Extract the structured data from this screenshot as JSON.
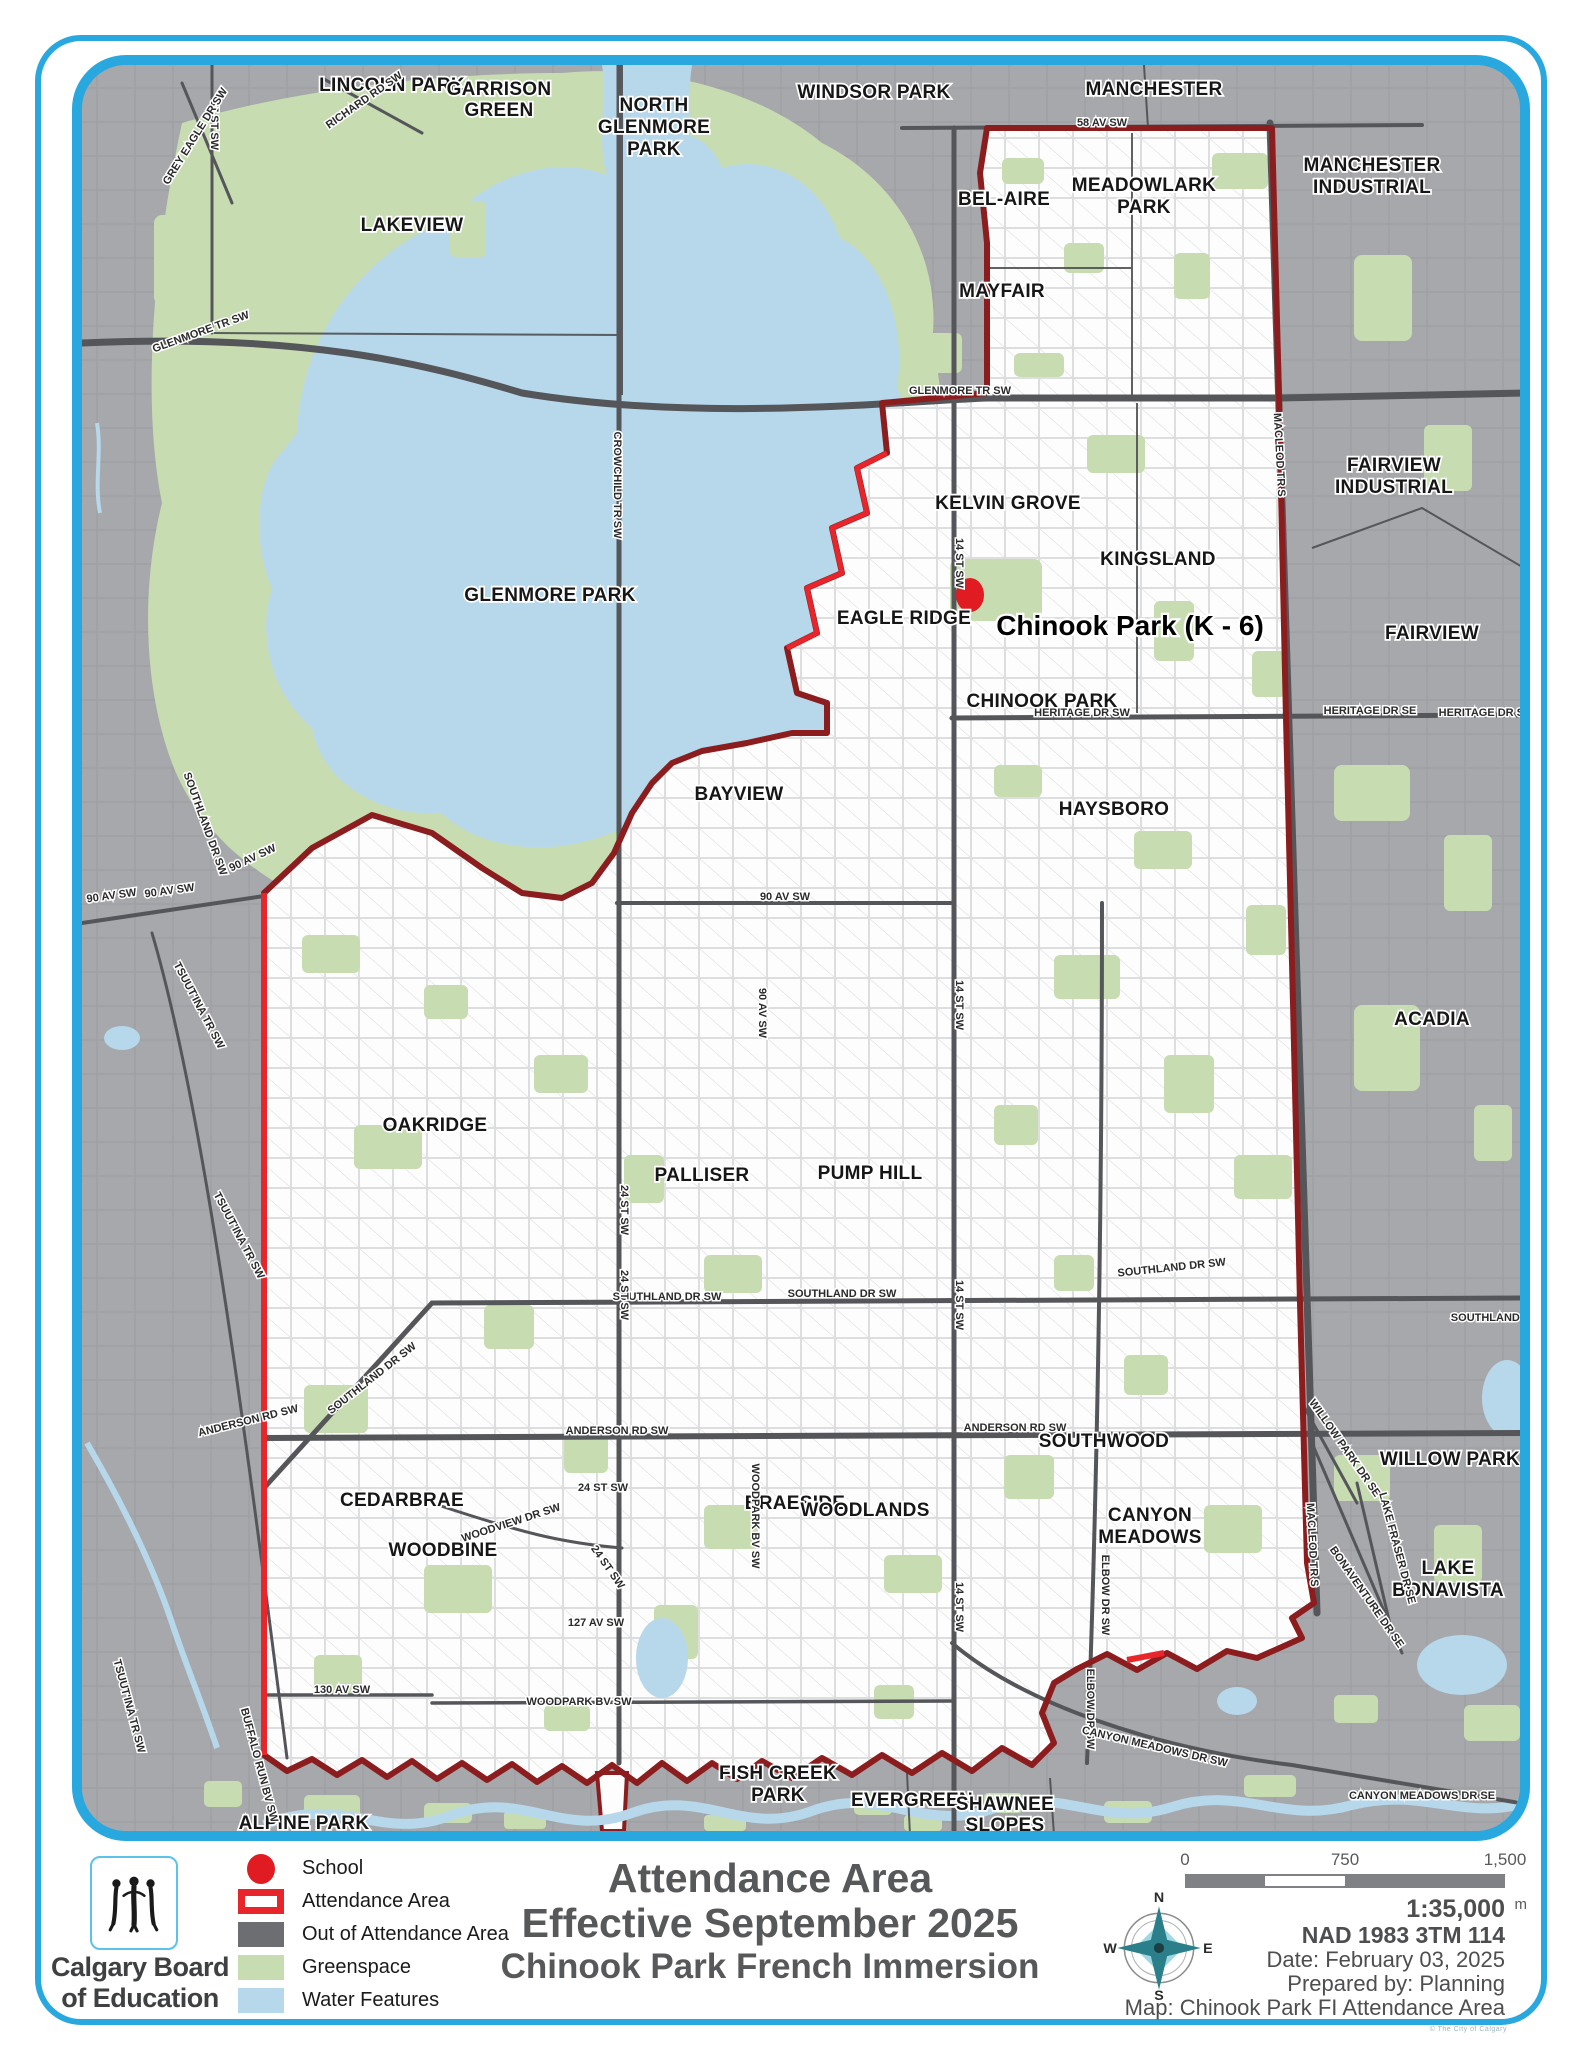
{
  "title": {
    "line1": "Attendance Area",
    "line2": "Effective September 2025",
    "line3": "Chinook Park French Immersion"
  },
  "logo": {
    "org_line1": "Calgary Board",
    "org_line2": "of Education"
  },
  "legend": {
    "items": [
      {
        "label": "School",
        "type": "school"
      },
      {
        "label": "Attendance Area",
        "type": "attendance"
      },
      {
        "label": "Out of Attendance Area",
        "type": "out"
      },
      {
        "label": "Greenspace",
        "type": "green"
      },
      {
        "label": "Water Features",
        "type": "water"
      }
    ]
  },
  "scale_bar": {
    "ticks": [
      "0",
      "750",
      "1,500"
    ],
    "unit": "m"
  },
  "compass": {
    "n": "N",
    "e": "E",
    "s": "S",
    "w": "W"
  },
  "map_info": {
    "scale_ratio": "1:35,000",
    "datum": "NAD 1983 3TM 114",
    "date_label": "Date: February 03, 2025",
    "prepared_label": "Prepared by: Planning",
    "map_label": "Map: Chinook Park FI Attendance Area"
  },
  "fine_print": "© The City of Calgary",
  "school": {
    "name": "Chinook Park (K - 6)",
    "x": 968,
    "y": 592
  },
  "colors": {
    "frame_blue": "#29a8e0",
    "out_of_area": "#a6a8ab",
    "attendance_white": "#ffffff",
    "greenspace": "#c8dcb2",
    "water": "#b7d7eb",
    "boundary_dark_red": "#8c1d1f",
    "boundary_bright_red": "#e8252a",
    "road": "#55565a",
    "title_gray": "#57585a"
  },
  "map": {
    "labels": [
      {
        "t": "LINCOLN PARK",
        "x": 390,
        "y": 88,
        "c": "nb"
      },
      {
        "t": "GARRISON",
        "x": 497,
        "y": 92,
        "c": "nb"
      },
      {
        "t": "GREEN",
        "x": 497,
        "y": 113,
        "c": "nb"
      },
      {
        "t": "NORTH",
        "x": 652,
        "y": 108,
        "c": "nb"
      },
      {
        "t": "GLENMORE",
        "x": 652,
        "y": 130,
        "c": "nb"
      },
      {
        "t": "PARK",
        "x": 652,
        "y": 152,
        "c": "nb"
      },
      {
        "t": "LAKEVIEW",
        "x": 410,
        "y": 228,
        "c": "nb"
      },
      {
        "t": "WINDSOR PARK",
        "x": 872,
        "y": 95,
        "c": "nb"
      },
      {
        "t": "MANCHESTER",
        "x": 1152,
        "y": 92,
        "c": "nb"
      },
      {
        "t": "MANCHESTER",
        "x": 1370,
        "y": 168,
        "c": "nb"
      },
      {
        "t": "INDUSTRIAL",
        "x": 1370,
        "y": 190,
        "c": "nb"
      },
      {
        "t": "BEL-AIRE",
        "x": 1002,
        "y": 202,
        "c": "nb"
      },
      {
        "t": "MEADOWLARK",
        "x": 1142,
        "y": 188,
        "c": "nb"
      },
      {
        "t": "PARK",
        "x": 1142,
        "y": 210,
        "c": "nb"
      },
      {
        "t": "MAYFAIR",
        "x": 1000,
        "y": 294,
        "c": "nb"
      },
      {
        "t": "FAIRVIEW",
        "x": 1392,
        "y": 468,
        "c": "nb"
      },
      {
        "t": "INDUSTRIAL",
        "x": 1392,
        "y": 490,
        "c": "nb"
      },
      {
        "t": "KELVIN GROVE",
        "x": 1006,
        "y": 506,
        "c": "nb"
      },
      {
        "t": "KINGSLAND",
        "x": 1156,
        "y": 562,
        "c": "nb"
      },
      {
        "t": "FAIRVIEW",
        "x": 1430,
        "y": 636,
        "c": "nb"
      },
      {
        "t": "GLENMORE PARK",
        "x": 548,
        "y": 598,
        "c": "nb"
      },
      {
        "t": "EAGLE RIDGE",
        "x": 902,
        "y": 621,
        "c": "nb"
      },
      {
        "t": "CHINOOK PARK",
        "x": 1040,
        "y": 704,
        "c": "nb"
      },
      {
        "t": "HAYSBORO",
        "x": 1112,
        "y": 812,
        "c": "nb"
      },
      {
        "t": "ACADIA",
        "x": 1430,
        "y": 1022,
        "c": "nb"
      },
      {
        "t": "BAYVIEW",
        "x": 737,
        "y": 797,
        "c": "nb"
      },
      {
        "t": "OAKRIDGE",
        "x": 433,
        "y": 1128,
        "c": "nb"
      },
      {
        "t": "PALLISER",
        "x": 700,
        "y": 1178,
        "c": "nb"
      },
      {
        "t": "PUMP HILL",
        "x": 868,
        "y": 1176,
        "c": "nb"
      },
      {
        "t": "SOUTHWOOD",
        "x": 1102,
        "y": 1444,
        "c": "nb"
      },
      {
        "t": "WILLOW PARK",
        "x": 1448,
        "y": 1462,
        "c": "nb"
      },
      {
        "t": "CEDARBRAE",
        "x": 400,
        "y": 1503,
        "c": "nb"
      },
      {
        "t": "BRAESIDE",
        "x": 793,
        "y": 1506,
        "c": "nb"
      },
      {
        "t": "WOODBINE",
        "x": 441,
        "y": 1553,
        "c": "nb"
      },
      {
        "t": "WOODLANDS",
        "x": 863,
        "y": 1513,
        "c": "nb"
      },
      {
        "t": "CANYON",
        "x": 1148,
        "y": 1518,
        "c": "nb"
      },
      {
        "t": "MEADOWS",
        "x": 1148,
        "y": 1540,
        "c": "nb"
      },
      {
        "t": "LAKE",
        "x": 1446,
        "y": 1571,
        "c": "nb"
      },
      {
        "t": "BONAVISTA",
        "x": 1446,
        "y": 1593,
        "c": "nb"
      },
      {
        "t": "FISH CREEK",
        "x": 776,
        "y": 1776,
        "c": "nb"
      },
      {
        "t": "PARK",
        "x": 776,
        "y": 1798,
        "c": "nb"
      },
      {
        "t": "EVERGREEN",
        "x": 910,
        "y": 1803,
        "c": "nb"
      },
      {
        "t": "SHAWNEE",
        "x": 1003,
        "y": 1807,
        "c": "nb"
      },
      {
        "t": "SLOPES",
        "x": 1003,
        "y": 1828,
        "c": "nb"
      },
      {
        "t": "ALPINE PARK",
        "x": 302,
        "y": 1826,
        "c": "nb"
      },
      {
        "t": "58 AV SW",
        "x": 1100,
        "y": 123,
        "c": "st"
      },
      {
        "t": "GLENMORE TR SW",
        "x": 958,
        "y": 391,
        "c": "st"
      },
      {
        "t": "GLENMORE TR SW",
        "x": 200,
        "y": 332,
        "r": -20,
        "c": "st"
      },
      {
        "t": "HERITAGE DR SW",
        "x": 1080,
        "y": 713,
        "c": "st"
      },
      {
        "t": "HERITAGE DR SE",
        "x": 1368,
        "y": 711,
        "c": "st"
      },
      {
        "t": "HERITAGE DR SE",
        "x": 1483,
        "y": 713,
        "c": "st"
      },
      {
        "t": "90 AV SW",
        "x": 110,
        "y": 896,
        "r": -8,
        "c": "st"
      },
      {
        "t": "90 AV SW",
        "x": 168,
        "y": 891,
        "r": -8,
        "c": "st"
      },
      {
        "t": "90 AV SW",
        "x": 252,
        "y": 858,
        "r": -25,
        "c": "st"
      },
      {
        "t": "90 AV SW",
        "x": 783,
        "y": 897,
        "c": "st"
      },
      {
        "t": "90 AV SW",
        "x": 757,
        "y": 1010,
        "r": 90,
        "c": "st"
      },
      {
        "t": "SOUTHLAND DR SW",
        "x": 200,
        "y": 822,
        "r": 70,
        "c": "st"
      },
      {
        "t": "SOUTHLAND DR SW",
        "x": 372,
        "y": 1378,
        "r": -38,
        "c": "st"
      },
      {
        "t": "SOUTHLAND DR SW",
        "x": 665,
        "y": 1297,
        "c": "st"
      },
      {
        "t": "SOUTHLAND DR SW",
        "x": 840,
        "y": 1294,
        "c": "st"
      },
      {
        "t": "SOUTHLAND DR SW",
        "x": 1170,
        "y": 1268,
        "r": -6,
        "c": "st"
      },
      {
        "t": "SOUTHLAND DR S",
        "x": 1498,
        "y": 1318,
        "c": "st"
      },
      {
        "t": "ANDERSON RD SW",
        "x": 247,
        "y": 1421,
        "r": -14,
        "c": "st"
      },
      {
        "t": "ANDERSON RD SW",
        "x": 615,
        "y": 1431,
        "c": "st"
      },
      {
        "t": "ANDERSON RD SW",
        "x": 1013,
        "y": 1428,
        "c": "st"
      },
      {
        "t": "24 ST SW",
        "x": 619,
        "y": 1207,
        "r": 90,
        "c": "st"
      },
      {
        "t": "24 ST SW",
        "x": 619,
        "y": 1292,
        "r": 90,
        "c": "st"
      },
      {
        "t": "24 ST SW",
        "x": 601,
        "y": 1488,
        "c": "st"
      },
      {
        "t": "24 ST SW",
        "x": 603,
        "y": 1566,
        "r": 55,
        "c": "st"
      },
      {
        "t": "14 ST SW",
        "x": 954,
        "y": 560,
        "r": 90,
        "c": "st"
      },
      {
        "t": "14 ST SW",
        "x": 954,
        "y": 1002,
        "r": 90,
        "c": "st"
      },
      {
        "t": "14 ST SW",
        "x": 954,
        "y": 1302,
        "r": 90,
        "c": "st"
      },
      {
        "t": "14 ST SW",
        "x": 954,
        "y": 1604,
        "r": 90,
        "c": "st"
      },
      {
        "t": "MACLEOD TR S",
        "x": 1274,
        "y": 452,
        "r": 87,
        "c": "st"
      },
      {
        "t": "MACLEOD TR S",
        "x": 1307,
        "y": 1542,
        "r": 87,
        "c": "st"
      },
      {
        "t": "ELBOW DR SW",
        "x": 1100,
        "y": 1592,
        "r": 90,
        "c": "st"
      },
      {
        "t": "ELBOW DR SW",
        "x": 1085,
        "y": 1706,
        "r": 90,
        "c": "st"
      },
      {
        "t": "CROWCHILD TR SW",
        "x": 612,
        "y": 482,
        "r": 90,
        "c": "st"
      },
      {
        "t": "37 ST SW",
        "x": 209,
        "y": 122,
        "r": 90,
        "c": "st"
      },
      {
        "t": "GREY EAGLE DR SW",
        "x": 196,
        "y": 135,
        "r": -58,
        "c": "st"
      },
      {
        "t": "RICHARD RD SW",
        "x": 364,
        "y": 100,
        "r": -35,
        "c": "st"
      },
      {
        "t": "WOODVIEW DR SW",
        "x": 510,
        "y": 1523,
        "r": -18,
        "c": "st"
      },
      {
        "t": "WOODPARK BV SW",
        "x": 750,
        "y": 1513,
        "r": 90,
        "c": "st"
      },
      {
        "t": "WOODPARK BV SW",
        "x": 577,
        "y": 1702,
        "c": "st"
      },
      {
        "t": "127 AV SW",
        "x": 594,
        "y": 1623,
        "c": "st"
      },
      {
        "t": "130 AV SW",
        "x": 340,
        "y": 1690,
        "c": "st"
      },
      {
        "t": "TSUUT'INA TR SW",
        "x": 194,
        "y": 1004,
        "r": 62,
        "c": "st"
      },
      {
        "t": "TSUUT'INA TR SW",
        "x": 234,
        "y": 1234,
        "r": 62,
        "c": "st"
      },
      {
        "t": "TSUUT'INA TR SW",
        "x": 124,
        "y": 1704,
        "r": 75,
        "c": "st"
      },
      {
        "t": "BUFFALO RUN BV SW",
        "x": 254,
        "y": 1763,
        "r": 75,
        "c": "st"
      },
      {
        "t": "CANYON MEADOWS DR SW",
        "x": 1152,
        "y": 1747,
        "r": 13,
        "c": "st"
      },
      {
        "t": "CANYON MEADOWS DR SE",
        "x": 1420,
        "y": 1796,
        "c": "st"
      },
      {
        "t": "WILLOW PARK DR SE",
        "x": 1340,
        "y": 1447,
        "r": 55,
        "c": "st"
      },
      {
        "t": "BONAVENTURE DR SE",
        "x": 1362,
        "y": 1596,
        "r": 55,
        "c": "st"
      },
      {
        "t": "LAKE FRASER DR SE",
        "x": 1392,
        "y": 1546,
        "r": 75,
        "c": "st"
      },
      {
        "t": "Chinook Park (K - 6)",
        "x": 1128,
        "y": 632,
        "c": "sch"
      }
    ]
  }
}
